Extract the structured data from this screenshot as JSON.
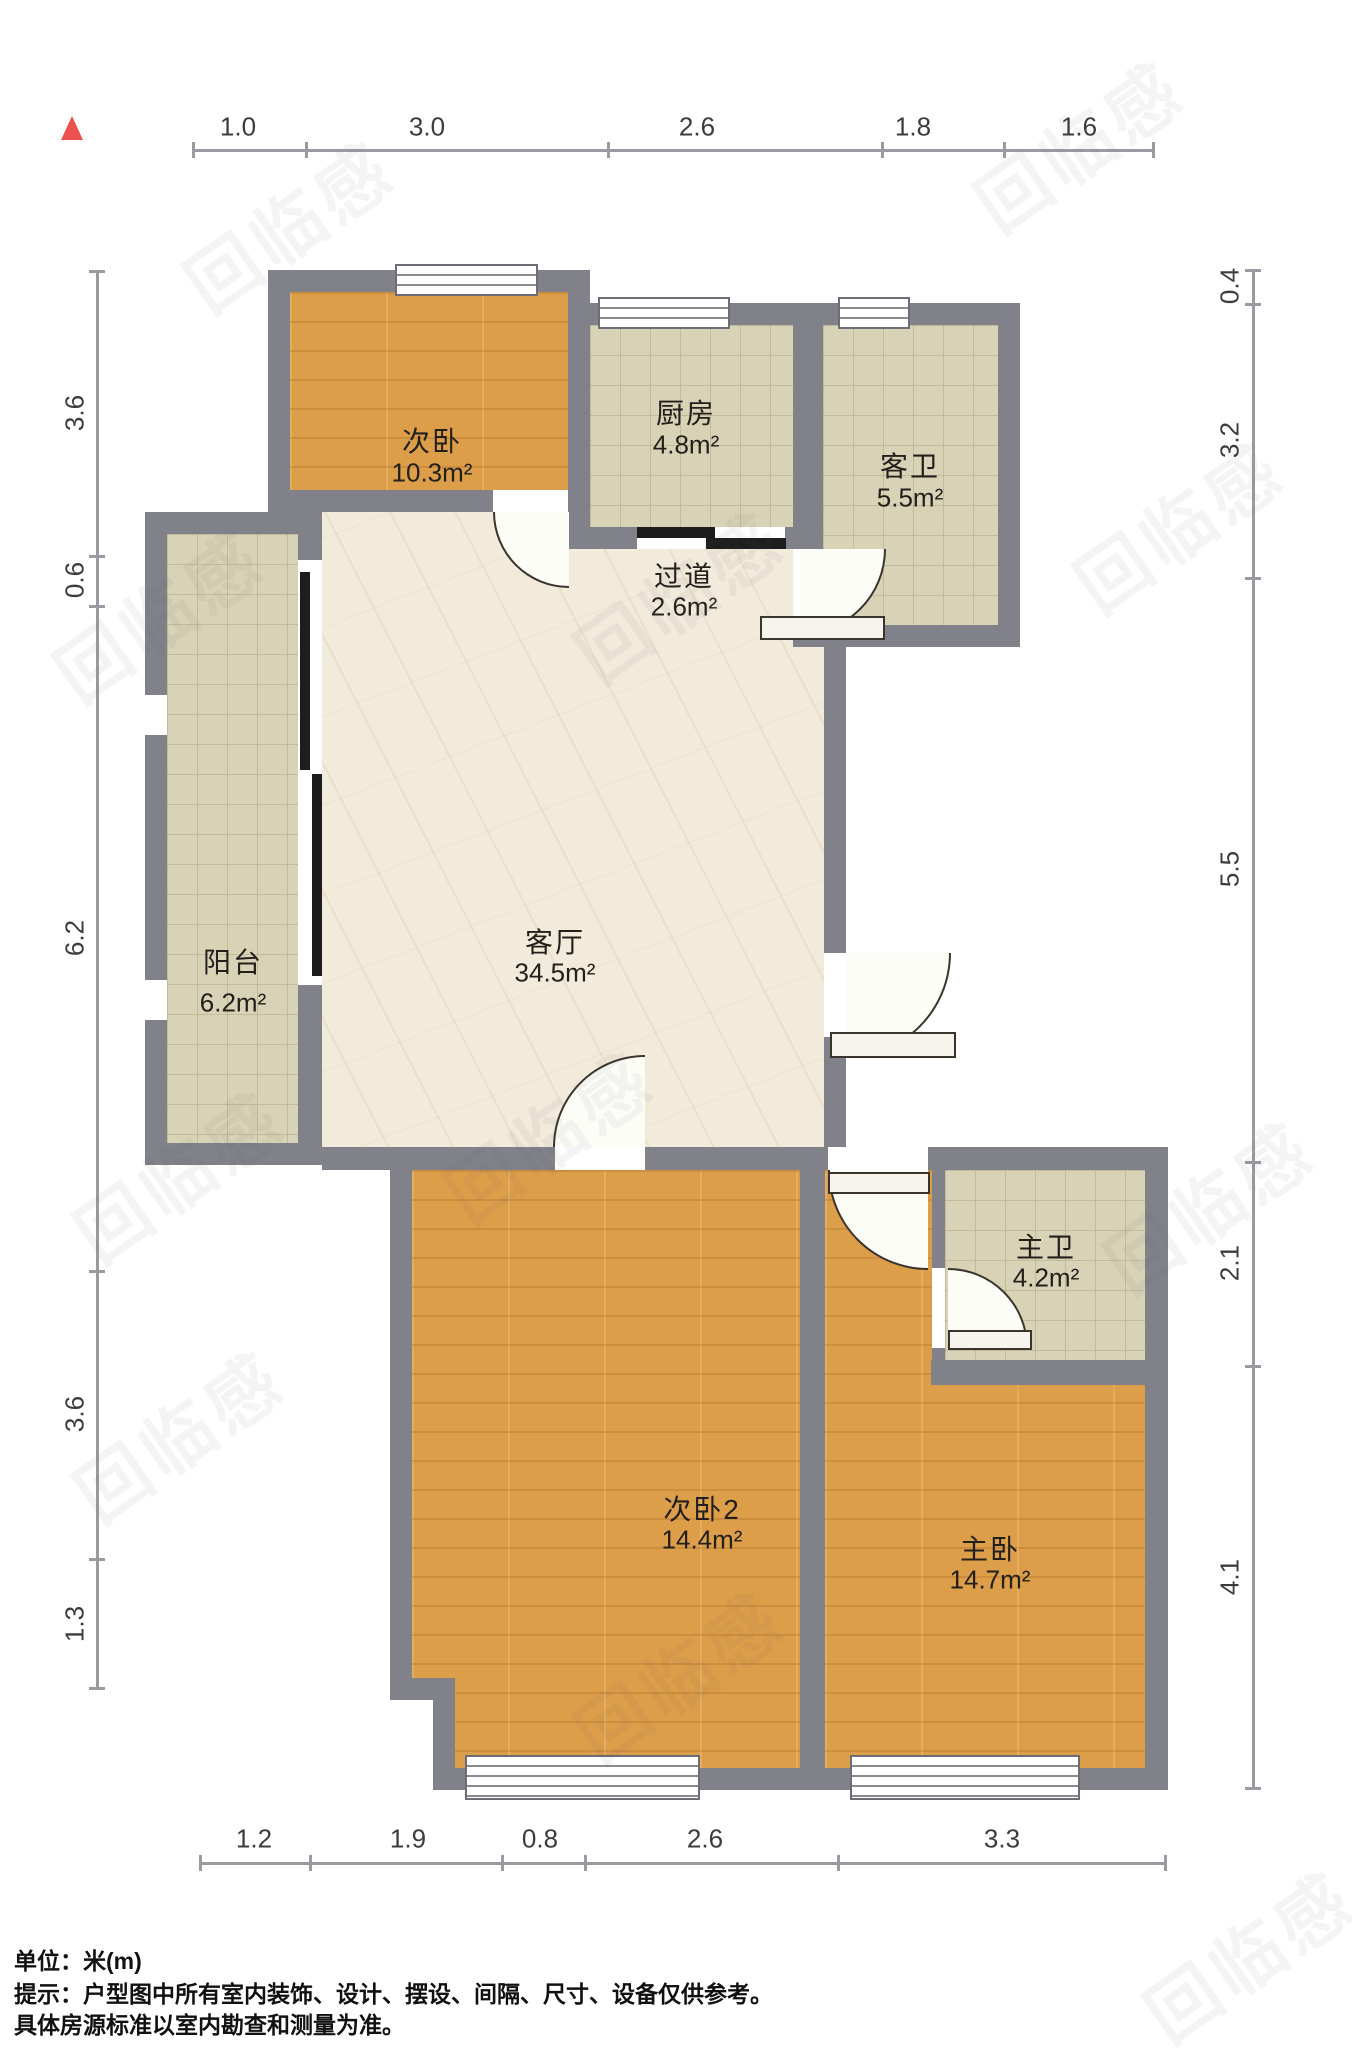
{
  "rooms": [
    {
      "id": "bedroom2",
      "name": "次卧",
      "area": "10.3m²"
    },
    {
      "id": "kitchen",
      "name": "厨房",
      "area": "4.8m²"
    },
    {
      "id": "guest-bathroom",
      "name": "客卫",
      "area": "5.5m²"
    },
    {
      "id": "hallway",
      "name": "过道",
      "area": "2.6m²"
    },
    {
      "id": "living-room",
      "name": "客厅",
      "area": "34.5m²"
    },
    {
      "id": "balcony",
      "name": "阳台",
      "area": "6.2m²"
    },
    {
      "id": "master-bathroom",
      "name": "主卫",
      "area": "4.2m²"
    },
    {
      "id": "bedroom3",
      "name": "次卧2",
      "area": "14.4m²"
    },
    {
      "id": "master-bedroom",
      "name": "主卧",
      "area": "14.7m²"
    }
  ],
  "dimensions": {
    "top": [
      "1.0",
      "3.0",
      "2.6",
      "1.8",
      "1.6"
    ],
    "bottom": [
      "1.2",
      "1.9",
      "0.8",
      "2.6",
      "3.3"
    ],
    "left": [
      "3.6",
      "0.6",
      "6.2",
      "3.6",
      "1.3"
    ],
    "right": [
      "0.4",
      "3.2",
      "5.5",
      "2.1",
      "4.1"
    ]
  },
  "footer": {
    "unit": "单位：米(m)",
    "notice1": "提示：户型图中所有室内装饰、设计、摆设、间隔、尺寸、设备仅供参考。",
    "notice2": "具体房源标准以室内勘查和测量为准。"
  },
  "watermark": {
    "text": "回临感"
  },
  "colors": {
    "wall": "#81818a",
    "wood": "#dd9e4a",
    "tile": "#d8d2b6",
    "marble": "#f2ebdb",
    "north_arrow": "#e9504e",
    "dim_text": "#3c3c3c"
  }
}
